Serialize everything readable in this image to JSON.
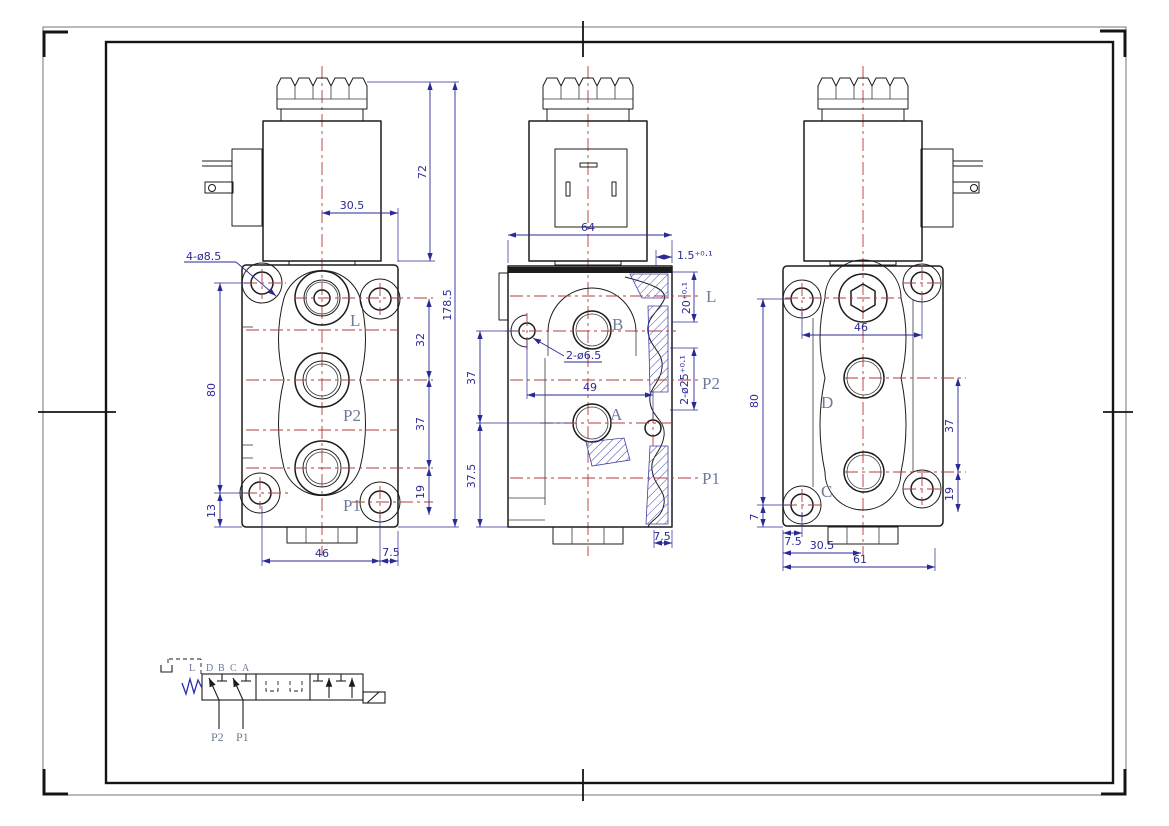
{
  "sheet": {
    "background": "#ffffff",
    "outline_color": "#1c1c1c",
    "centerline_color": "#b23b3b",
    "dimension_color": "#2a2a96",
    "port_label_color": "#6e7a98",
    "hatch_color": "#3c3ca6",
    "spring_color": "#2b2bb4"
  },
  "front_view": {
    "port_l": "L",
    "port_p2": "P2",
    "port_p1": "P1",
    "note_holes": "4-ø8.5",
    "dim_coil_height": "72",
    "dim_offset": "30.5",
    "dim_total_height": "178.5",
    "dim_left_height": "80",
    "dim_left_bottom": "13",
    "dim_right_32": "32",
    "dim_right_37": "37",
    "dim_right_19": "19",
    "dim_bottom_46": "46",
    "dim_bottom_75": "7.5"
  },
  "section_view": {
    "port_b": "B",
    "port_a": "A",
    "label_l": "L",
    "label_p2": "P2",
    "label_p1": "P1",
    "dim_width": "64",
    "dim_lip": "1.5⁺⁰·¹",
    "dim_depth": "20⁺⁰·¹",
    "dim_bores": "2-ø25⁺⁰·¹",
    "note_holes": "2-ø6.5",
    "dim_49": "49",
    "dim_37": "37",
    "dim_375": "37.5",
    "dim_75": "7.5"
  },
  "back_view": {
    "port_d": "D",
    "port_c": "C",
    "dim_46": "46",
    "dim_80": "80",
    "dim_7": "7",
    "dim_37": "37",
    "dim_19": "19",
    "dim_75": "7.5",
    "dim_305": "30.5",
    "dim_61": "61"
  },
  "schematic": {
    "label_l": "L",
    "ports_top": [
      "D",
      "B",
      "C",
      "A"
    ],
    "label_p2": "P2",
    "label_p1": "P1"
  }
}
